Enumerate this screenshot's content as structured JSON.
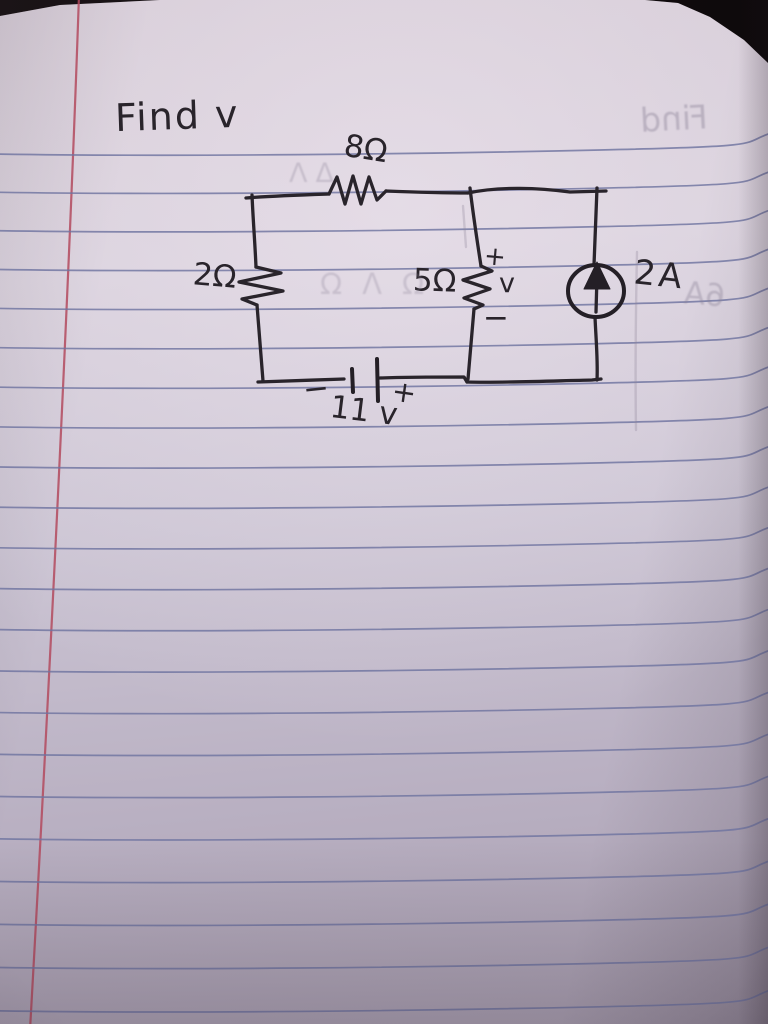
{
  "photo": {
    "paper_color": "#c9c1cf",
    "background_color": "#140f12",
    "rule_line_color": "#6f74a0",
    "margin_line_color": "#b34a5e",
    "ink_color": "#29242b"
  },
  "problem": {
    "title": "Find v"
  },
  "circuit": {
    "top_resistor_label": "8Ω",
    "left_resistor_label": "2Ω",
    "middle_resistor_label": "5Ω",
    "middle_plus": "+",
    "middle_unknown": "v",
    "middle_minus": "−",
    "current_source_label": "2A",
    "battery_minus": "−",
    "battery_value": "11 v",
    "battery_plus": "+"
  },
  "bleed_through": {
    "title_ghost": "Find",
    "current_ghost": "6A",
    "top_squiggle_ghost": "ΔΛ",
    "mid_squiggle_ghost": "ΩΛΩ"
  }
}
